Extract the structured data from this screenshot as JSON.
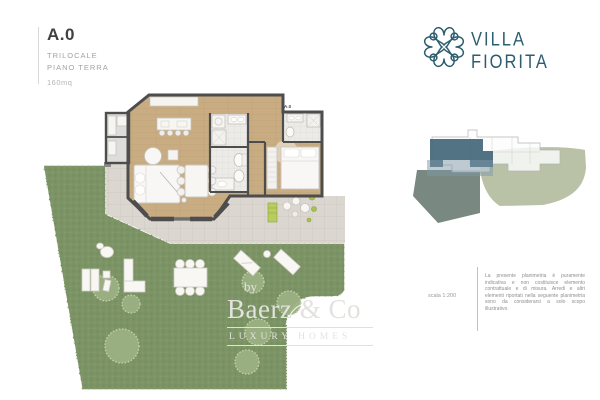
{
  "header": {
    "unit": "A.0",
    "rooms": "TRILOCALE",
    "floor": "PIANO TERRA",
    "area": "160mq"
  },
  "brand": {
    "line1": "VILLA",
    "line2": "FIORITA"
  },
  "plan": {
    "unit_label": "A.0"
  },
  "legend": {
    "scale": "scala 1:200",
    "disclaimer": "La presente planimetria è puramente indicativa e non costituisce elemento contrattuale e di misura. Arredi e altri elementi riportati nella seguente planimetria sono da considerarsi a solo scopo illustrativo."
  },
  "watermark": {
    "prefix": "by",
    "name": "Baerz & Co",
    "tagline": "LUXURY HOMES"
  },
  "palette": {
    "brand_teal": "#2d5e6f",
    "garden_green": "#7c9465",
    "bush_green": "#9cb183",
    "terrace_grey": "#dbd7d0",
    "wood": "#c9ac82",
    "wall_grey": "#4d4d4d",
    "bath_tile": "#ecebe8",
    "unit_highlight": "#44687b",
    "unit_highlight_light": "#7d97a6",
    "sage_dark": "#72827a",
    "sage_light": "#b9c2a6"
  }
}
